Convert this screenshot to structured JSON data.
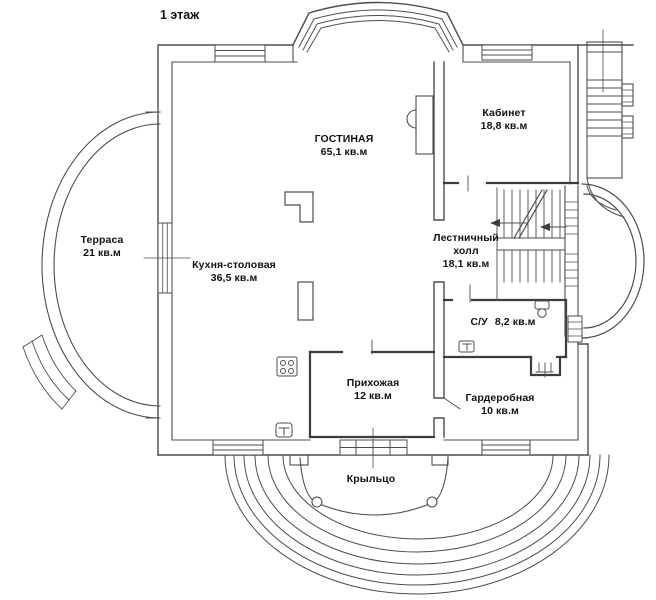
{
  "title": "1 этаж",
  "rooms": [
    {
      "name": "ГОСТИНАЯ",
      "area": "65,1 кв.м"
    },
    {
      "name": "Кабинет",
      "area": "18,8 кв.м"
    },
    {
      "name": "Терраса",
      "area": "21 кв.м"
    },
    {
      "name": "Кухня-столовая",
      "area": "36,5 кв.м"
    },
    {
      "name": "Лестничный холл",
      "area": "18,1 кв.м"
    },
    {
      "name": "С/У",
      "area": "8,2 кв.м"
    },
    {
      "name": "Прихожая",
      "area": "12 кв.м"
    },
    {
      "name": "Гардеробная",
      "area": "10 кв.м"
    },
    {
      "name": "Крыльцо",
      "area": ""
    }
  ],
  "colors": {
    "wall": "#4d4d4d",
    "text": "#111111",
    "background": "#ffffff"
  }
}
